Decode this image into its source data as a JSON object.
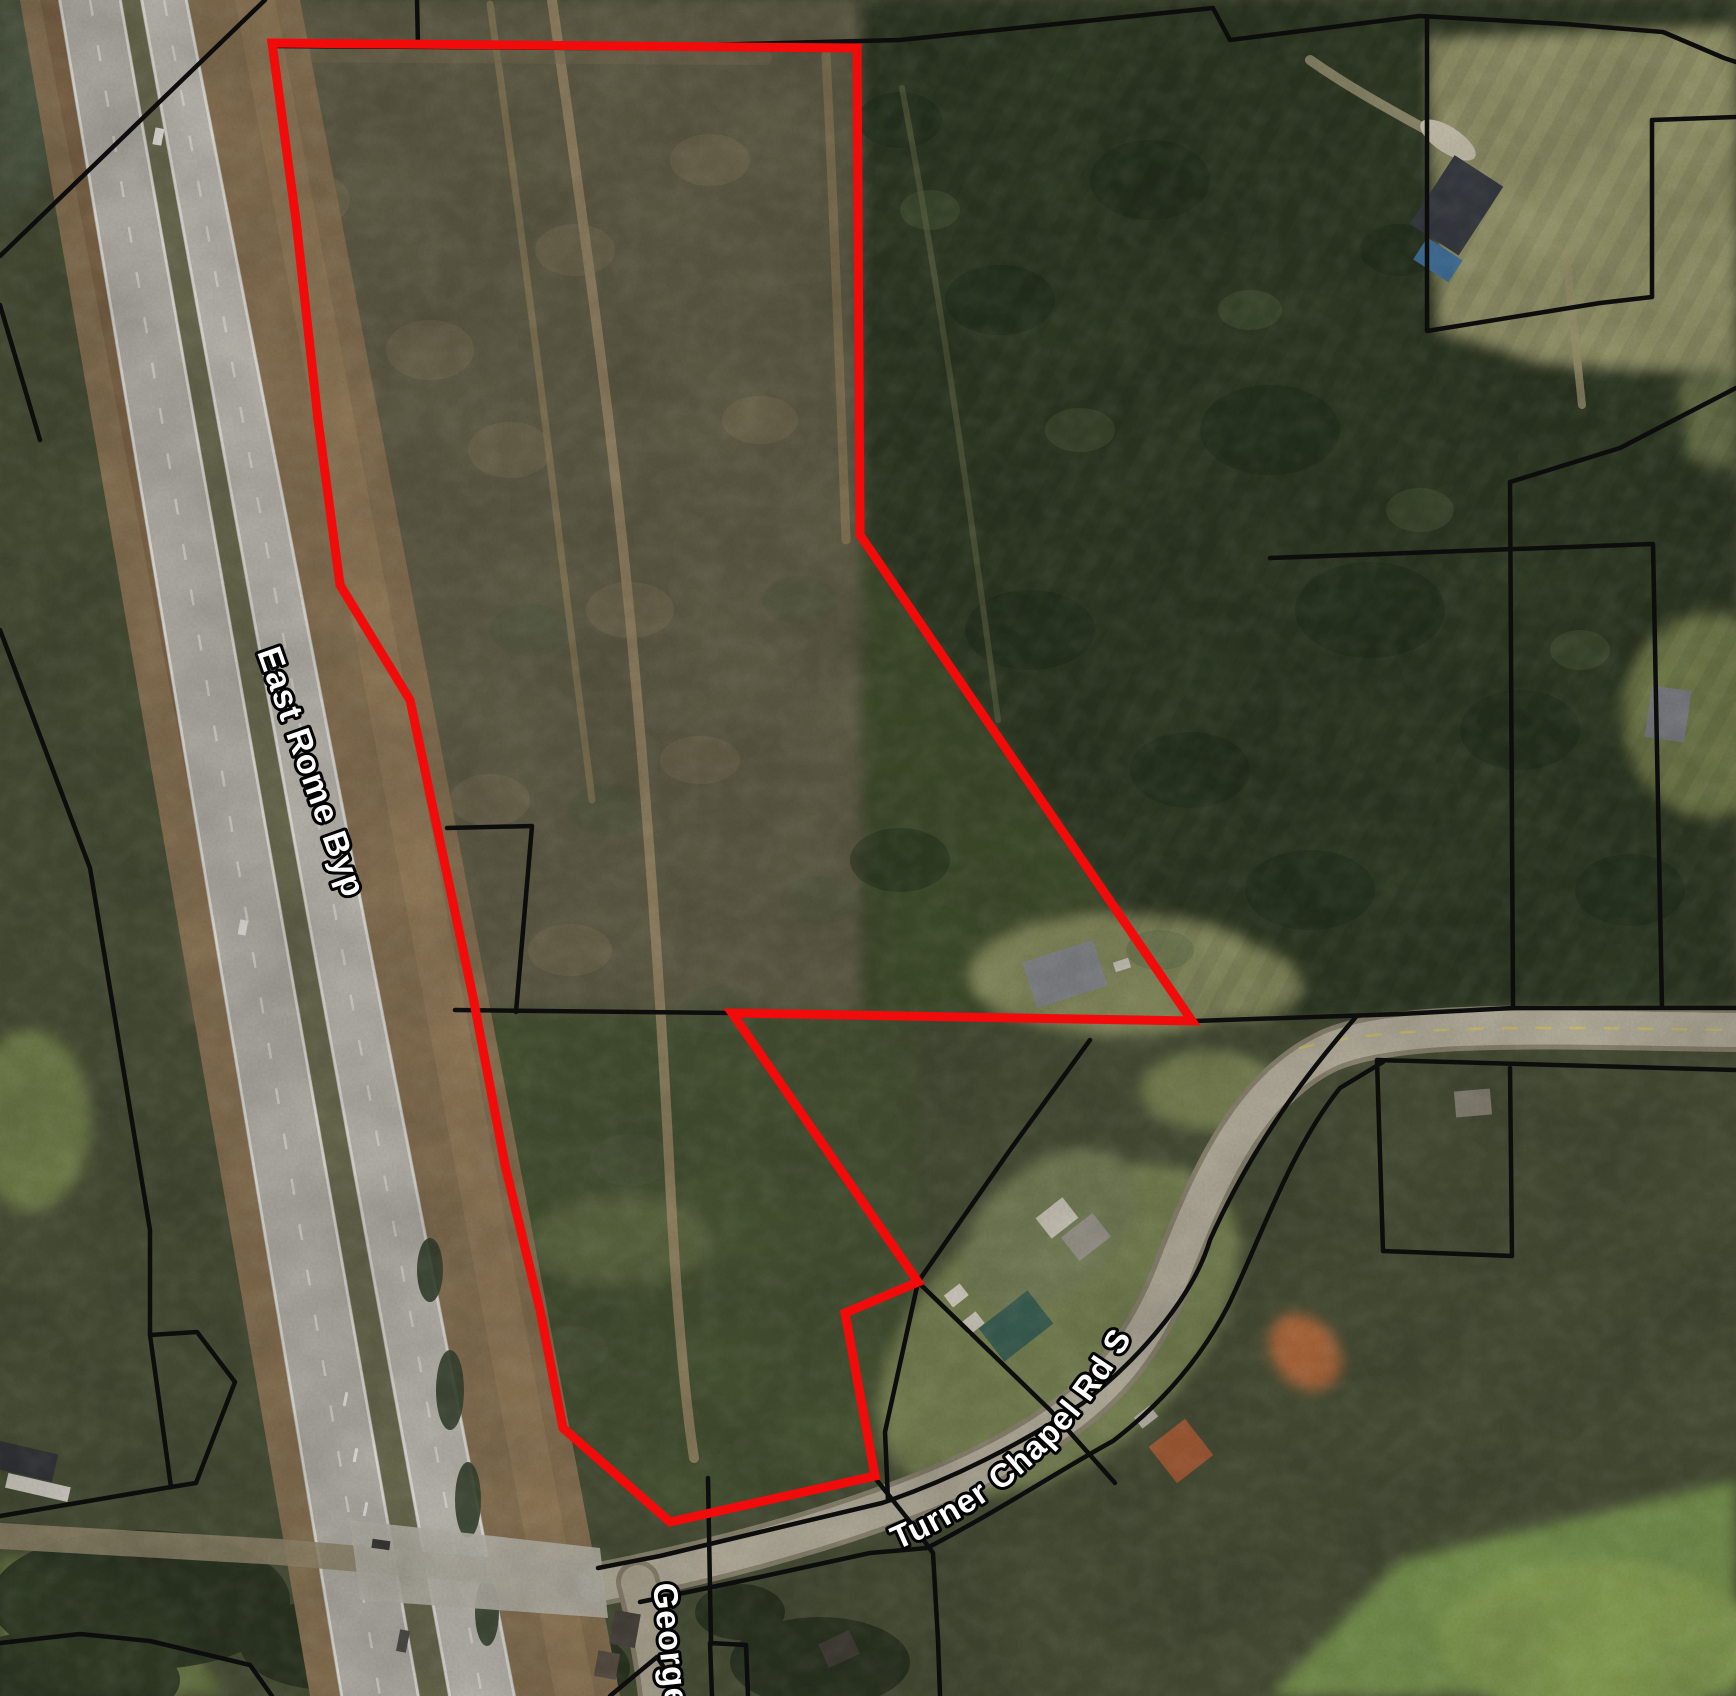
{
  "map": {
    "labels": {
      "highway": "East Rome Byp",
      "main_road": "Turner Chapel Rd SE",
      "side_street": "George"
    },
    "colors": {
      "parcel_boundary": "#f10b0b",
      "parcel_lines": "#0d0d0d",
      "road_label_fill": "#ffffff",
      "road_label_outline": "#000000"
    },
    "parcel": {
      "red_outline_points": "272,43 857,48 860,535 1192,1021 732,1013 918,1282 845,1313 875,1476 670,1522 563,1428 540,1310 505,1165 473,997 410,700 340,585 318,420 296,220"
    }
  }
}
